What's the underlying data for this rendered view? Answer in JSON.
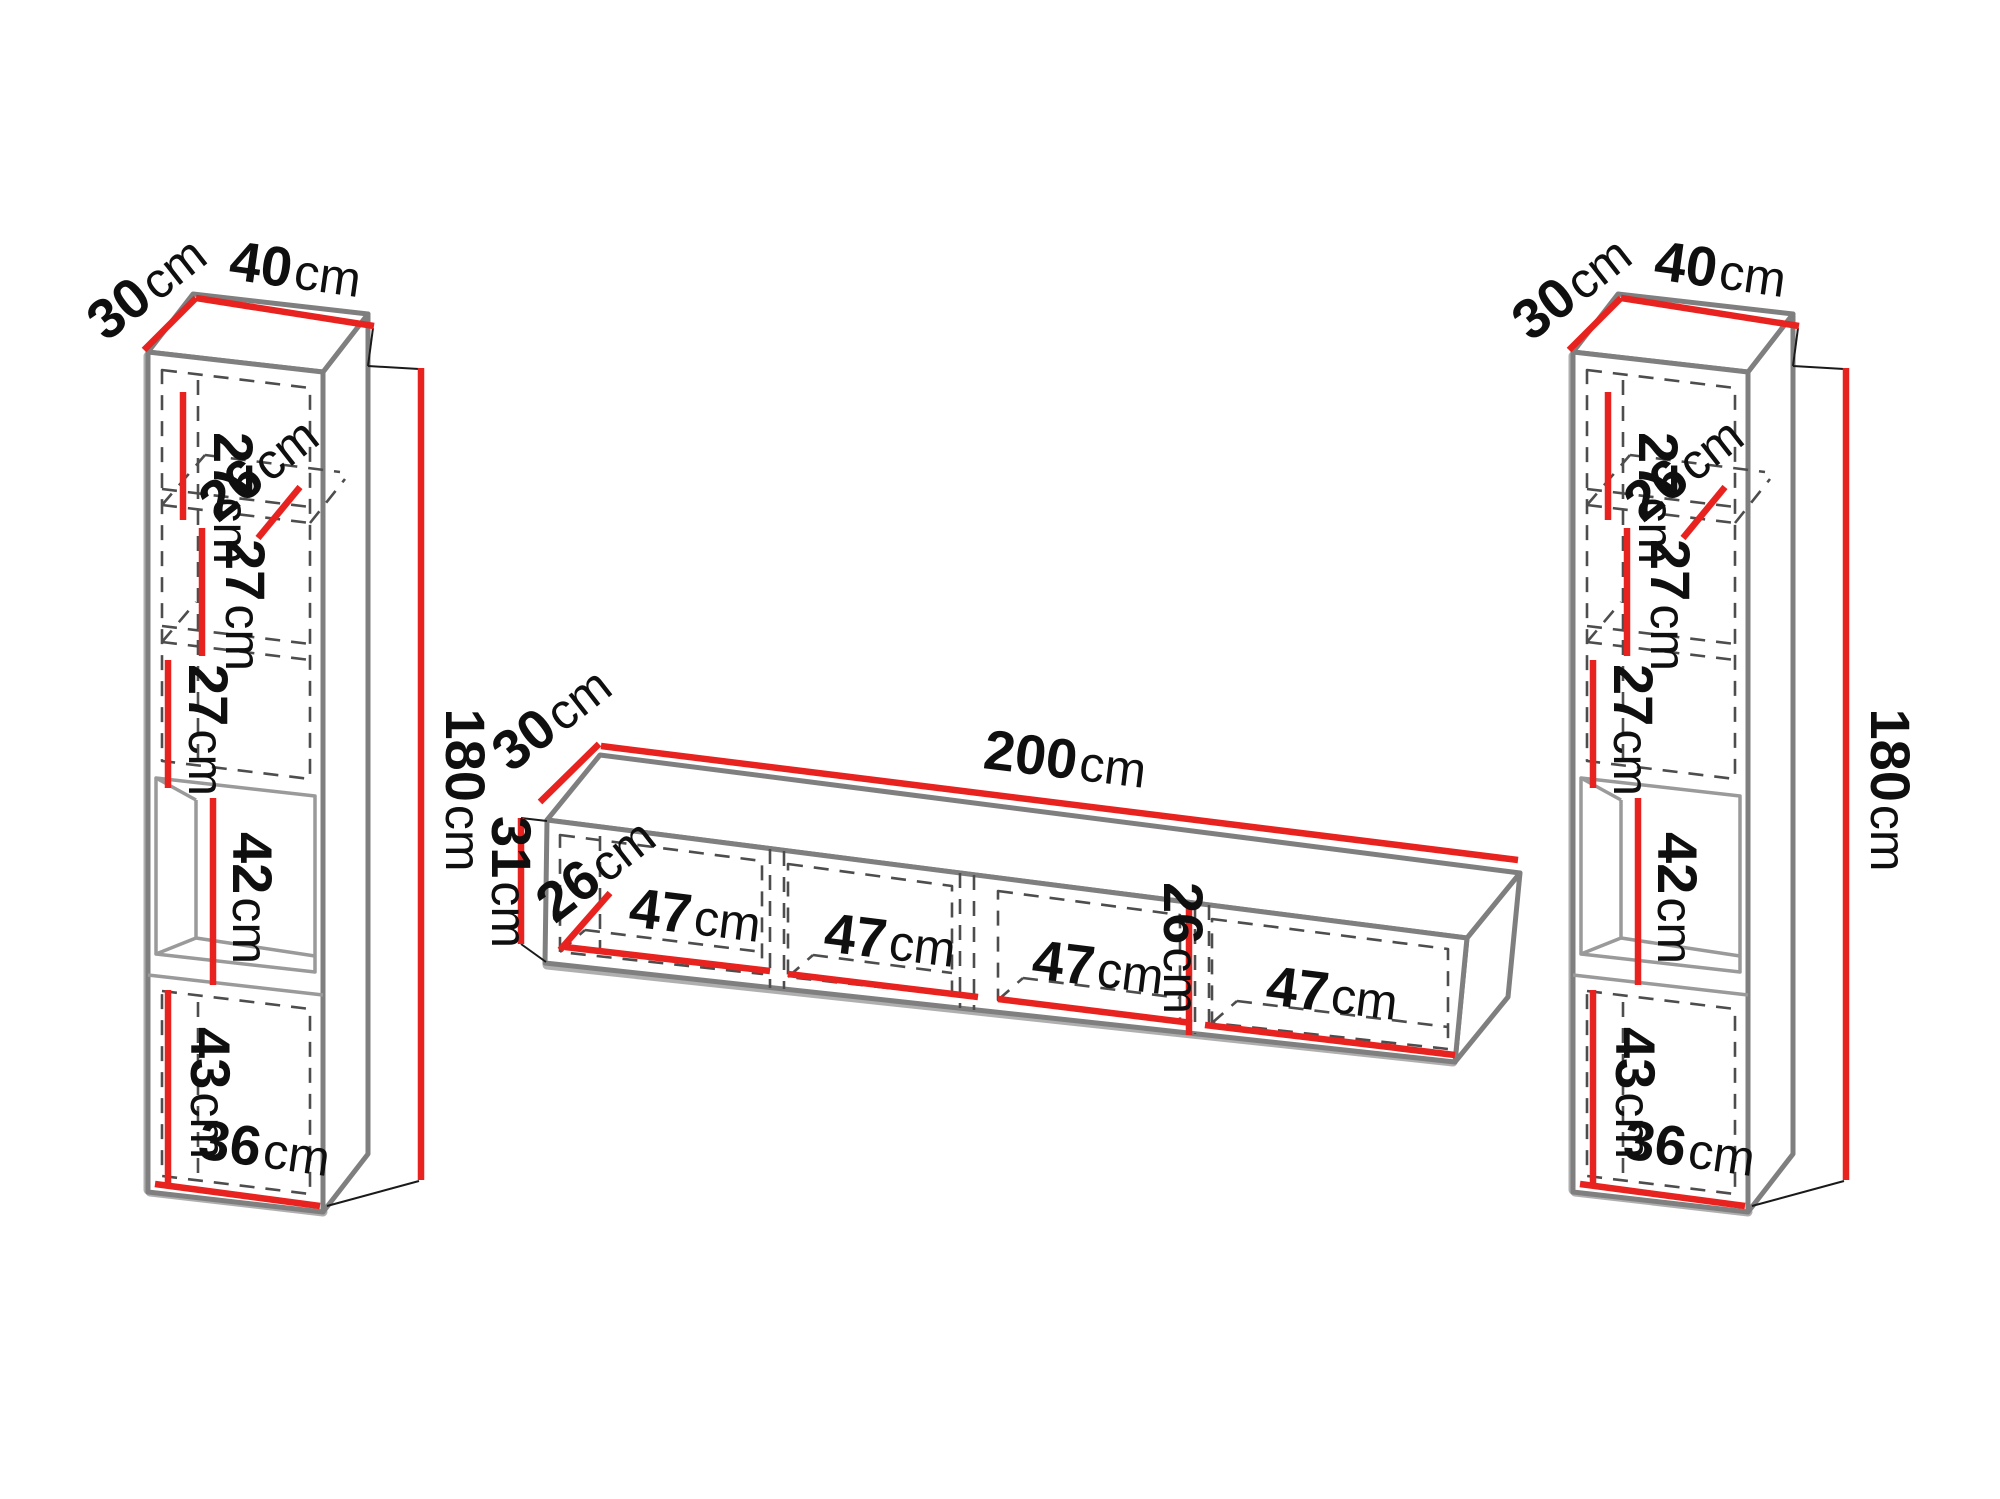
{
  "diagram": {
    "unit": "cm",
    "left_cabinet": {
      "depth": {
        "v": "30",
        "u": "cm"
      },
      "width": {
        "v": "40",
        "u": "cm"
      },
      "height": {
        "v": "180",
        "u": "cm"
      },
      "shelf1": {
        "v": "27",
        "u": "cm"
      },
      "shelf_depth": {
        "v": "26",
        "u": "cm"
      },
      "shelf2": {
        "v": "27",
        "u": "cm"
      },
      "shelf3": {
        "v": "27",
        "u": "cm"
      },
      "niche": {
        "v": "42",
        "u": "cm"
      },
      "bottom": {
        "v": "43",
        "u": "cm"
      },
      "bottom_width": {
        "v": "36",
        "u": "cm"
      }
    },
    "tv_stand": {
      "depth": {
        "v": "30",
        "u": "cm"
      },
      "width": {
        "v": "200",
        "u": "cm"
      },
      "height": {
        "v": "31",
        "u": "cm"
      },
      "shelf_depth": {
        "v": "26",
        "u": "cm"
      },
      "inner_height": {
        "v": "26",
        "u": "cm"
      },
      "compartments": [
        {
          "v": "47",
          "u": "cm"
        },
        {
          "v": "47",
          "u": "cm"
        },
        {
          "v": "47",
          "u": "cm"
        },
        {
          "v": "47",
          "u": "cm"
        }
      ]
    },
    "right_cabinet": {
      "depth": {
        "v": "30",
        "u": "cm"
      },
      "width": {
        "v": "40",
        "u": "cm"
      },
      "height": {
        "v": "180",
        "u": "cm"
      },
      "shelf1": {
        "v": "27",
        "u": "cm"
      },
      "shelf_depth": {
        "v": "26",
        "u": "cm"
      },
      "shelf2": {
        "v": "27",
        "u": "cm"
      },
      "shelf3": {
        "v": "27",
        "u": "cm"
      },
      "niche": {
        "v": "42",
        "u": "cm"
      },
      "bottom": {
        "v": "43",
        "u": "cm"
      },
      "bottom_width": {
        "v": "36",
        "u": "cm"
      }
    }
  },
  "colors": {
    "dimension": "#e8231f",
    "outline": "#7f7f7f",
    "text": "#0f0f0f",
    "dash": "#4d4d4d"
  }
}
